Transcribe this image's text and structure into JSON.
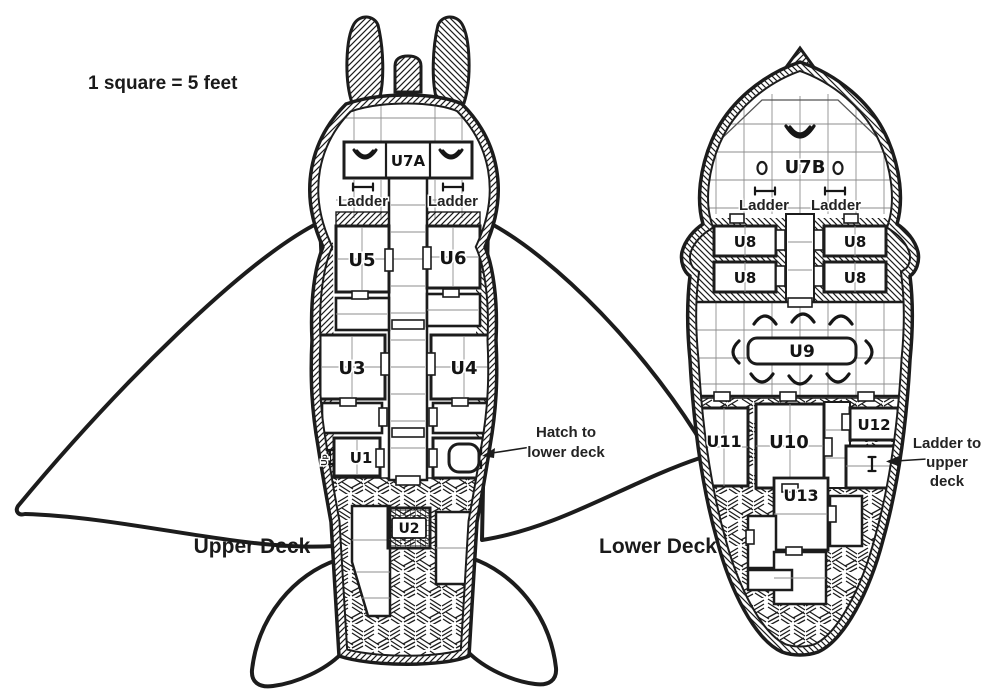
{
  "scale_note": "1 square = 5 feet",
  "colors": {
    "ink": "#1c1c1c",
    "paper": "#ffffff"
  },
  "upper_deck": {
    "title": "Upper Deck",
    "rooms": {
      "u7a": "U7A",
      "u5": "U5",
      "u6": "U6",
      "u3": "U3",
      "u4": "U4",
      "u1": "U1",
      "u2": "U2"
    },
    "annotations": {
      "ladder": "Ladder",
      "up": "Up",
      "hatch_line1": "Hatch to",
      "hatch_line2": "lower deck"
    }
  },
  "lower_deck": {
    "title": "Lower Deck",
    "rooms": {
      "u7b": "U7B",
      "u8": "U8",
      "u9": "U9",
      "u10": "U10",
      "u11": "U11",
      "u12": "U12",
      "u13": "U13"
    },
    "annotations": {
      "ladder": "Ladder",
      "ladder_up_line1": "Ladder to",
      "ladder_up_line2": "upper",
      "ladder_up_line3": "deck"
    }
  }
}
